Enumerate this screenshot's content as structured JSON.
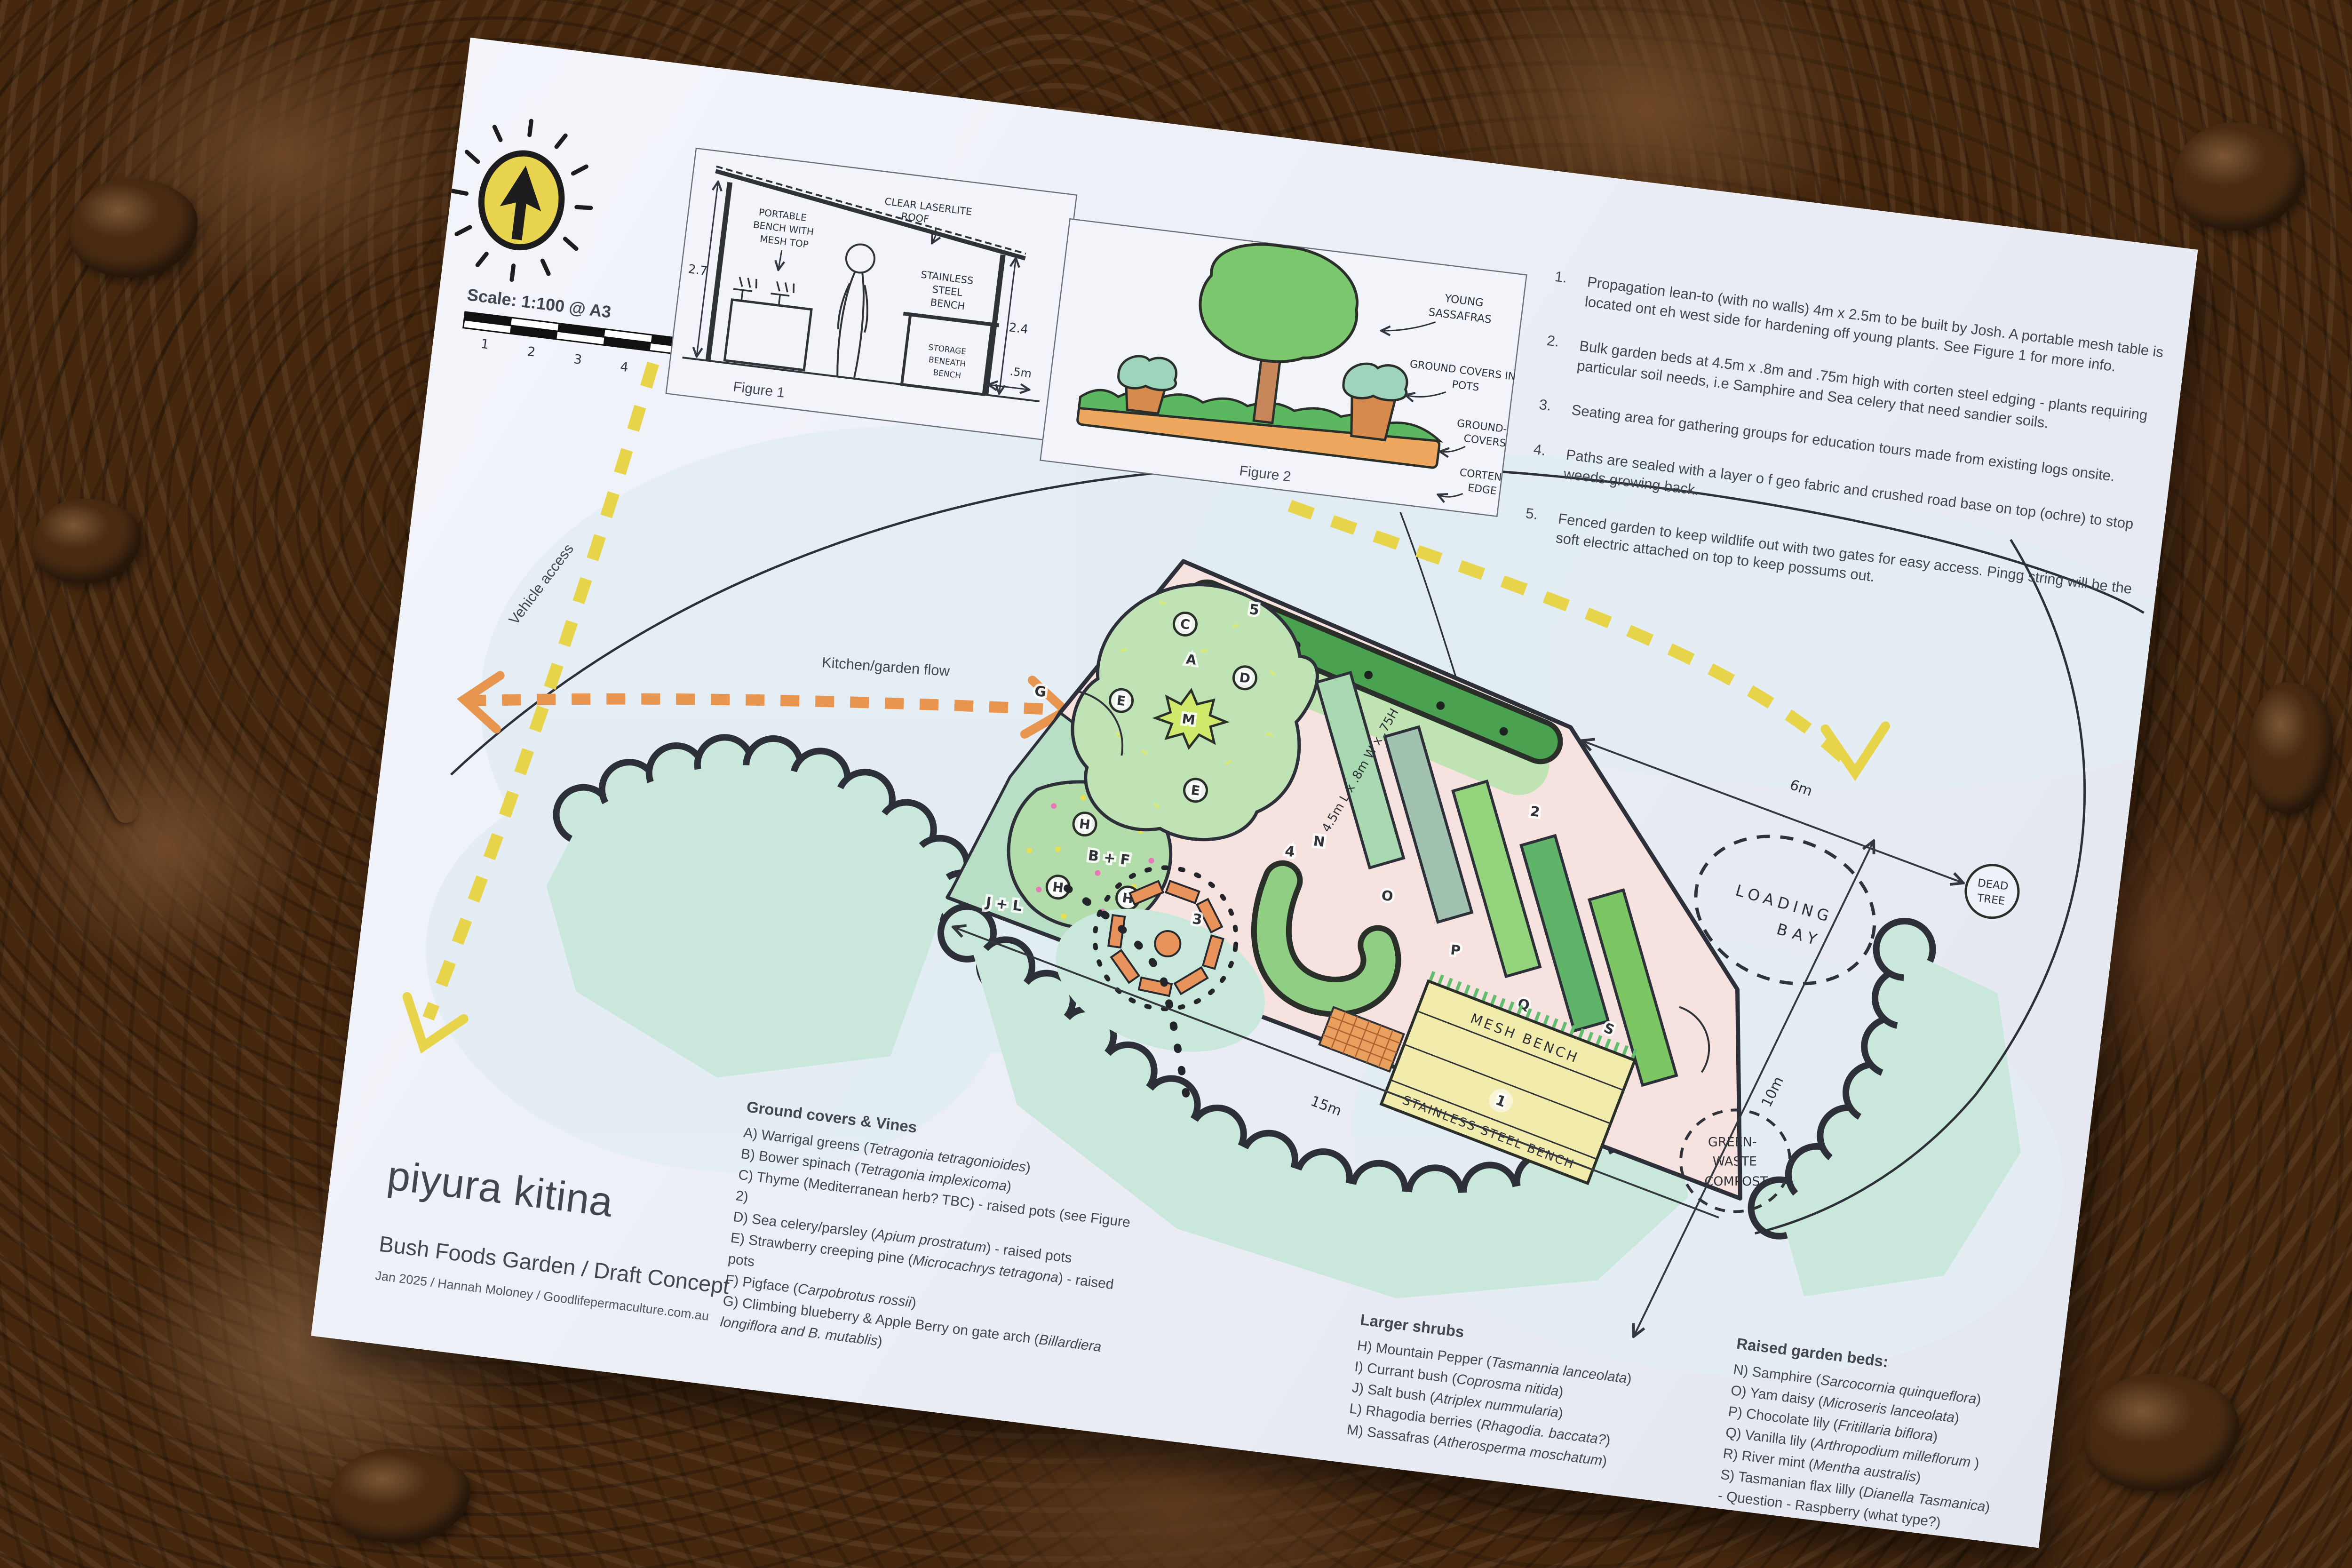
{
  "scale": {
    "label": "Scale: 1:100 @ A3",
    "ticks": [
      "1",
      "2",
      "3",
      "4",
      "5"
    ]
  },
  "title_block": {
    "title": "piyura kitina",
    "subtitle": "Bush Foods Garden / Draft Concept",
    "byline": "Jan 2025 / Hannah Moloney / Goodlifepermaculture.com.au"
  },
  "notes": {
    "items": [
      {
        "num": "1.",
        "text": "Propagation lean-to (with no walls) 4m x 2.5m to be built by Josh. A portable mesh table is located ont eh west side for hardening off young plants.  See Figure 1 for more info."
      },
      {
        "num": "2.",
        "text": "Bulk garden beds at 4.5m x .8m and .75m high with corten steel edging - plants requiring particular soil needs, i.e Samphire and Sea celery that need sandier soils."
      },
      {
        "num": "3.",
        "text": "Seating area for gathering groups for education tours made from existing logs onsite."
      },
      {
        "num": "4.",
        "text": "Paths are sealed with a layer o f geo fabric and crushed road base on top (ochre) to stop weeds growing back."
      },
      {
        "num": "5.",
        "text": "Fenced garden to keep wildlife out with two gates for easy access. Pingg string will be the soft electric attached on top to keep possums out."
      }
    ]
  },
  "fig1": {
    "caption": "Figure 1",
    "roof1": "CLEAR LASERLITE",
    "roof2": "ROOF",
    "bench1": "PORTABLE",
    "bench2": "BENCH WITH",
    "bench3": "MESH TOP",
    "ss1": "STAINLESS",
    "ss2": "STEEL",
    "ss3": "BENCH",
    "st1": "STORAGE",
    "st2": "BENEATH",
    "st3": "BENCH",
    "dimL": "2.7",
    "dimR": "2.4",
    "dimS": ".5m",
    "f1": "WILDLIFE",
    "f2": "PROOF",
    "f3": "FENCE"
  },
  "fig2": {
    "caption": "Figure 2",
    "y1": "YOUNG",
    "y2": "SASSAFRAS",
    "p1": "GROUND COVERS IN",
    "p2": "POTS",
    "g1": "GROUND-",
    "g2": "COVERS",
    "c1": "CORTEN",
    "c2": "EDGE"
  },
  "plan": {
    "vehicle": "Vehicle access",
    "kitchen": "Kitchen/garden flow",
    "i": "I",
    "c": "C",
    "a": "A",
    "d": "D",
    "e": "E",
    "m": "M",
    "h": "H",
    "bf": "B + F",
    "jl": "J + L",
    "g": "G",
    "n": "N",
    "o": "O",
    "p": "P",
    "q": "Q",
    "r": "R",
    "s": "S",
    "n1": "1",
    "n2": "2",
    "n3": "3",
    "n4": "4",
    "n5": "5",
    "d15": "15m",
    "d10": "10m",
    "d6": "6m",
    "bed_dim": "4.5m L x .8m W x .75H",
    "loading1": "LOADING",
    "loading2": "BAY",
    "dead1": "DEAD",
    "dead2": "TREE",
    "comp1": "GREEN-",
    "comp2": "WASTE",
    "comp3": "COMPOST",
    "mesh": "MESH BENCH",
    "ssb": "STAINLESS STEEL BENCH"
  },
  "legends": {
    "ground": {
      "title": "Ground covers & Vines",
      "items": [
        {
          "a": "A) Warrigal greens (",
          "b": "Tetragonia tetragonioides",
          "c": ")"
        },
        {
          "a": "B) Bower spinach (",
          "b": "Tetragonia implexicoma",
          "c": ")"
        },
        {
          "a": "C)  Thyme (Mediterranean herb? TBC) - raised pots (see Figure 2)",
          "b": "",
          "c": ""
        },
        {
          "a": "D) Sea celery/parsley (",
          "b": "Apium prostratum",
          "c": ") - raised pots"
        },
        {
          "a": "E) Strawberry creeping pine (",
          "b": "Microcachrys tetragona",
          "c": ") - raised pots"
        },
        {
          "a": "F) Pigface (",
          "b": "Carpobrotus rossii",
          "c": ")"
        },
        {
          "a": "G) Climbing blueberry & Apple Berry on gate arch (",
          "b": "Billardiera longiflora  and B. mutablis",
          "c": ")"
        }
      ]
    },
    "shrubs": {
      "title": "Larger shrubs",
      "items": [
        {
          "a": "H) Mountain Pepper (",
          "b": "Tasmannia lanceolata",
          "c": ")"
        },
        {
          "a": "I) Currant bush (",
          "b": "Coprosma nitida",
          "c": ")"
        },
        {
          "a": "J) Salt bush (",
          "b": "Atriplex nummularia",
          "c": ")"
        },
        {
          "a": "L) Rhagodia berries (",
          "b": "Rhagodia. baccata?",
          "c": ")"
        },
        {
          "a": "M)  Sassafras (",
          "b": "Atherosperma moschatum",
          "c": ")"
        }
      ]
    },
    "beds": {
      "title": "Raised garden beds:",
      "items": [
        {
          "a": "N) Samphire (",
          "b": "Sarcocornia quinqueflora",
          "c": ")"
        },
        {
          "a": "O) Yam daisy (",
          "b": "Microseris lanceolata",
          "c": ")"
        },
        {
          "a": "P) Chocolate lily (",
          "b": "Fritillaria biflora",
          "c": ")"
        },
        {
          "a": "Q) Vanilla lily (",
          "b": "Arthropodium milleflorum ",
          "c": ")"
        },
        {
          "a": "R) River mint (",
          "b": "Mentha australis",
          "c": ")"
        },
        {
          "a": "S) Tasmanian flax lilly (",
          "b": "Dianella Tasmanica",
          "c": ")"
        },
        {
          "a": "- Question - Raspberry (what type?)",
          "b": "",
          "c": ""
        }
      ]
    }
  },
  "colors": {
    "paper": "#edeff6",
    "soil": "#46280f",
    "yellow_dash": "#e7d44b",
    "orange_dash": "#e8954f",
    "garden_pink": "#f6e2de",
    "veg_teal": "#c9e7da",
    "wash_blue": "#e2edf3",
    "hedge_green": "#4aa251",
    "bed_greens": [
      "#a8d9b0",
      "#a2c2b0",
      "#93d47d",
      "#5fb46a",
      "#7cc763"
    ],
    "bench_yellow": "#f1ecac",
    "log_orange": "#e8935c",
    "logo_yellow": "#e9d44f"
  }
}
